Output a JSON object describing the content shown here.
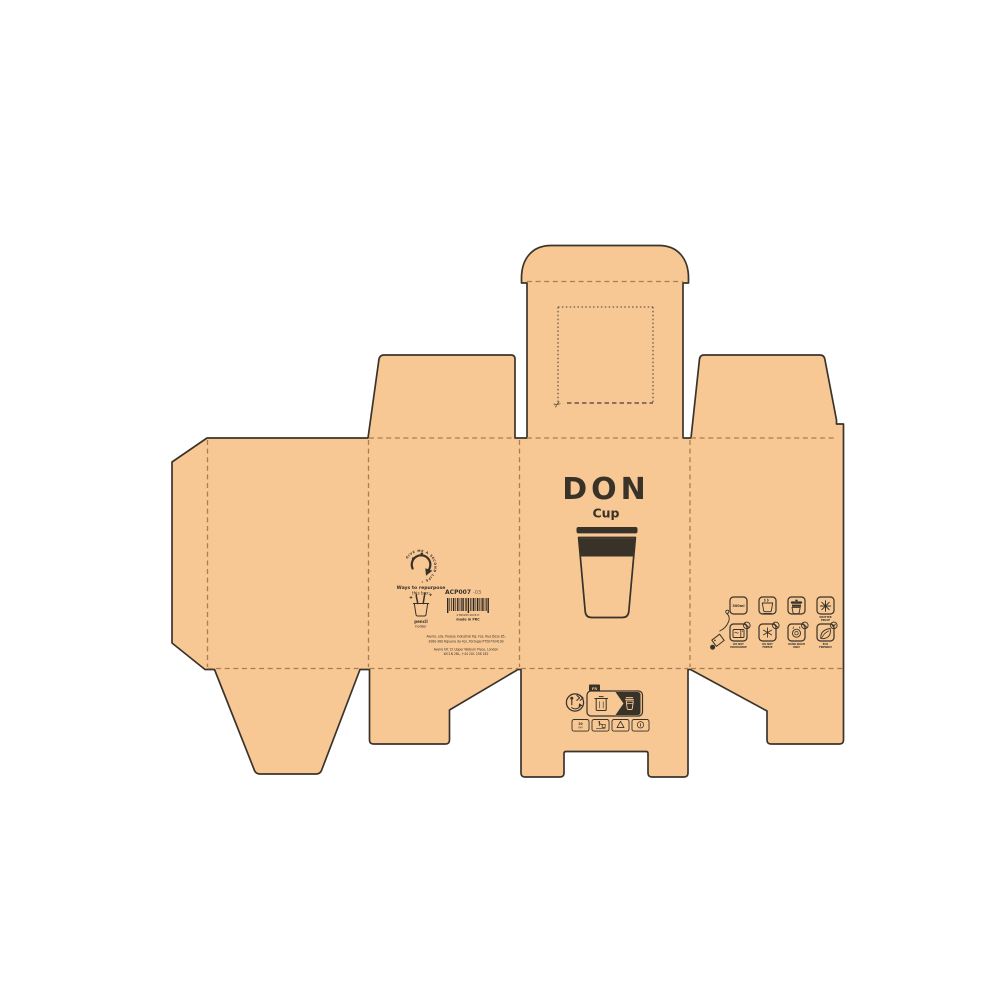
{
  "colors": {
    "background": "#ffffff",
    "kraft_board": "#f7c794",
    "cut_line": "#3a342c",
    "fold_line": "#a87f4e",
    "ink": "#383229"
  },
  "front_panel": {
    "brand": "DON",
    "product": "Cup"
  },
  "back_panel": {
    "circle_text": "GIVE ME A SECOND LIFE •",
    "repurpose_title": "Ways to repurpose",
    "repurpose_subtitle": "this box:",
    "idea_word1": "pencil",
    "idea_word2": "holder",
    "sku": "ACP007",
    "sku_rev": "-03",
    "barcode_digits": "4 895265 002317",
    "made_in": "made in PRC",
    "address_line1": "Aveiro, Lda. Parque Industrial Fig. Foz, Rua Doze 85,",
    "address_line2": "3080-380 Figueira da Foz, Portugal PT507434190",
    "address_line3": "Aveiro UK 15 Upper Woburn Place, London",
    "address_line4": "WC1N 2BL, +44 201 258 182"
  },
  "side_panel": {
    "capacity": "300ml",
    "row1_caption": [
      "SHATTER",
      "PROOF"
    ],
    "captions": [
      [
        "DO NOT",
        "MICROWAVE"
      ],
      [
        "DO NOT",
        "FREEZE"
      ],
      [
        "HAND WASH",
        "ONLY"
      ],
      [
        "ECO",
        "FRIENDLY"
      ]
    ]
  },
  "bottom_flap": {
    "country_tag": "FR",
    "material_code": "20",
    "material_name": "PAP"
  },
  "glyphs": {
    "scissors": "✂",
    "info_mark": "i"
  },
  "icon_names": [
    "scissors-icon",
    "second-life-arrow-icon",
    "pencil-holder-icon",
    "barcode",
    "cup-illustration",
    "triman-icon",
    "sorting-info-label",
    "waste-bin-icon",
    "tidyman-icon",
    "recycle-triangle-icon",
    "info-icon",
    "hang-tag-icon",
    "capacity-icon",
    "hot-drink-icon",
    "cold-drink-icon",
    "shatterproof-icon",
    "no-microwave-icon",
    "no-freeze-icon",
    "hand-wash-icon",
    "eco-leaf-icon"
  ]
}
